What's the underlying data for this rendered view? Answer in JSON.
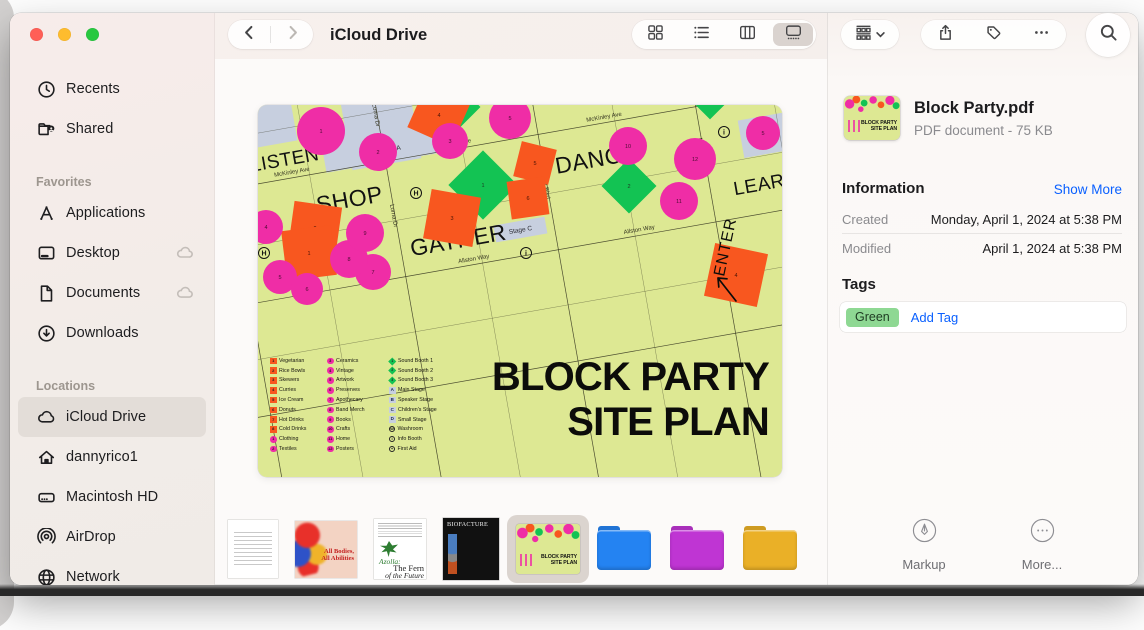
{
  "traffic_lights": {
    "close": "#ff5f57",
    "minimize": "#febc2e",
    "zoom": "#28c840"
  },
  "sidebar": {
    "top_items": [
      {
        "label": "Recents",
        "icon": "clock-icon"
      },
      {
        "label": "Shared",
        "icon": "shared-folder-icon"
      }
    ],
    "sections": [
      {
        "title": "Favorites",
        "items": [
          {
            "label": "Applications",
            "icon": "applications-icon"
          },
          {
            "label": "Desktop",
            "icon": "desktop-icon",
            "badge": "cloud-badge-icon"
          },
          {
            "label": "Documents",
            "icon": "document-icon",
            "badge": "cloud-badge-icon"
          },
          {
            "label": "Downloads",
            "icon": "downloads-icon"
          }
        ]
      },
      {
        "title": "Locations",
        "items": [
          {
            "label": "iCloud Drive",
            "icon": "icloud-icon",
            "selected": true
          },
          {
            "label": "dannyrico1",
            "icon": "home-icon"
          },
          {
            "label": "Macintosh HD",
            "icon": "harddrive-icon"
          },
          {
            "label": "AirDrop",
            "icon": "airdrop-icon"
          },
          {
            "label": "Network",
            "icon": "globe-icon"
          }
        ]
      }
    ]
  },
  "toolbar": {
    "title": "iCloud Drive",
    "view_buttons": [
      {
        "name": "icon-view",
        "icon": "view-grid-icon"
      },
      {
        "name": "list-view",
        "icon": "view-list-icon"
      },
      {
        "name": "column-view",
        "icon": "view-columns-icon"
      },
      {
        "name": "gallery-view",
        "icon": "view-gallery-icon",
        "selected": true
      }
    ],
    "actions": [
      {
        "name": "share",
        "icon": "share-icon",
        "stroked": true
      },
      {
        "name": "tags",
        "icon": "tag-icon",
        "stroked": true
      },
      {
        "name": "more",
        "icon": "ellipsis-icon"
      }
    ]
  },
  "map": {
    "bg": "#dde893",
    "colors": {
      "pink": "#ef2da6",
      "orange": "#f8571f",
      "green": "#13c353",
      "blue": "#c7cfdf"
    },
    "title": [
      "BLOCK PARTY",
      "SITE PLAN"
    ],
    "enter_label": "ENTER",
    "area_labels": [
      {
        "t": "LISTEN",
        "x": 53,
        "y": 22,
        "s": 19
      },
      {
        "t": "SHOP",
        "x": 110,
        "y": 74,
        "s": 23
      },
      {
        "t": "GATHER",
        "x": 210,
        "y": 133,
        "s": 23
      },
      {
        "t": "DANCE",
        "x": 360,
        "y": 77,
        "s": 23
      },
      {
        "t": "LEARN",
        "x": 523,
        "y": 129,
        "s": 19
      }
    ],
    "street_labels": [
      {
        "t": "McKinley Ave",
        "x": 58,
        "y": 31
      },
      {
        "t": "McKinley Ave",
        "x": 222,
        "y": 31
      },
      {
        "t": "McKinley Ave",
        "x": 375,
        "y": 31
      },
      {
        "t": "Allston Way",
        "x": 222,
        "y": 148
      },
      {
        "t": "Allston Way",
        "x": 390,
        "y": 148
      },
      {
        "t": "Lorna Dr",
        "x": 149,
        "y": -12,
        "v": 1
      },
      {
        "t": "Lorna Dr",
        "x": 149,
        "y": 90,
        "v": 1
      },
      {
        "t": "Beach Park Blvd",
        "x": 304,
        "y": 78,
        "v": 1
      },
      {
        "t": "Mayfair Ave",
        "x": 464,
        "y": 82,
        "v": 1
      }
    ],
    "stage_blocks": [
      {
        "x": 118,
        "y": -40,
        "w": 70,
        "h": 78
      },
      {
        "x": 92,
        "y": -8,
        "w": 126,
        "h": 44,
        "label": "Stage A",
        "lx": 158,
        "ly": 26
      },
      {
        "x": 25,
        "y": -49,
        "w": 44,
        "h": 48
      },
      {
        "x": 247,
        "y": 117,
        "w": 52,
        "h": 17,
        "label": "Stage C",
        "lx": 273,
        "ly": 128
      },
      {
        "x": 506,
        "y": 56,
        "w": 46,
        "h": 38,
        "label": "Stage D",
        "lx": 529,
        "ly": 78
      }
    ],
    "streets": {
      "h": [
        -60,
        35,
        152,
        265
      ],
      "v": [
        -5,
        152,
        307,
        467
      ],
      "h_minor": [
        -15,
        95,
        208
      ],
      "v_minor": [
        75,
        230,
        385,
        545
      ]
    },
    "circles": [
      [
        63,
        26,
        24,
        "1"
      ],
      [
        120,
        47,
        19,
        "2"
      ],
      [
        192,
        36,
        18,
        "3"
      ],
      [
        252,
        13,
        21,
        "5"
      ],
      [
        370,
        41,
        19,
        "10"
      ],
      [
        437,
        54,
        21,
        "12"
      ],
      [
        421,
        96,
        19,
        "11"
      ],
      [
        8,
        122,
        17,
        "4"
      ],
      [
        22,
        172,
        17,
        "5"
      ],
      [
        49,
        184,
        16,
        "6"
      ],
      [
        115,
        167,
        18,
        "7"
      ],
      [
        91,
        154,
        19,
        "8"
      ],
      [
        107,
        128,
        19,
        "9"
      ],
      [
        505,
        28,
        17,
        "5"
      ]
    ],
    "squares": [
      [
        57,
        123,
        48,
        8,
        "2"
      ],
      [
        51,
        148,
        50,
        -7,
        "1"
      ],
      [
        194,
        113,
        50,
        10,
        "3"
      ],
      [
        277,
        58,
        36,
        14,
        "5"
      ],
      [
        270,
        93,
        38,
        -8,
        "6"
      ],
      [
        181,
        10,
        48,
        24,
        "4"
      ],
      [
        478,
        170,
        54,
        12,
        "4"
      ]
    ],
    "diamonds": [
      [
        225,
        80,
        34,
        "1"
      ],
      [
        371,
        81,
        27,
        "2"
      ],
      [
        196,
        2,
        26,
        ""
      ],
      [
        452,
        -8,
        22,
        ""
      ]
    ],
    "markers": [
      [
        "H",
        158,
        88
      ],
      [
        "H",
        6,
        148
      ],
      [
        "i",
        466,
        27
      ],
      [
        "i",
        268,
        148
      ]
    ],
    "legend": {
      "columns": [
        {
          "cls": "lg-col1",
          "items": [
            [
              "sq",
              "1",
              "Vegetarian"
            ],
            [
              "sq",
              "2",
              "Rice Bowls"
            ],
            [
              "sq",
              "3",
              "Skewers"
            ],
            [
              "sq",
              "4",
              "Curries"
            ],
            [
              "sq",
              "5",
              "Ice Cream"
            ],
            [
              "sq",
              "6",
              "Donuts"
            ],
            [
              "sq",
              "7",
              "Hot Drinks"
            ],
            [
              "sq",
              "8",
              "Cold Drinks"
            ],
            [
              "pk",
              "1",
              "Clothing"
            ],
            [
              "pk",
              "2",
              "Textiles"
            ]
          ]
        },
        {
          "cls": "lg-col2",
          "items": [
            [
              "pk",
              "3",
              "Ceramics"
            ],
            [
              "pk",
              "4",
              "Vintage"
            ],
            [
              "pk",
              "5",
              "Artwork"
            ],
            [
              "pk",
              "6",
              "Preserves"
            ],
            [
              "pk",
              "7",
              "Apothecary"
            ],
            [
              "pk",
              "8",
              "Band Merch"
            ],
            [
              "pk",
              "9",
              "Books"
            ],
            [
              "pk",
              "10",
              "Crafts"
            ],
            [
              "pk",
              "11",
              "Home"
            ],
            [
              "pk",
              "12",
              "Posters"
            ]
          ]
        },
        {
          "cls": "lg-col3",
          "items": [
            [
              "gd",
              "1",
              "Sound Booth 1"
            ],
            [
              "gd",
              "2",
              "Sound Booth 2"
            ],
            [
              "gd",
              "3",
              "Sound Booth 3"
            ],
            [
              "lt",
              "A",
              "Main Stage"
            ],
            [
              "lt",
              "B",
              "Speaker Stage"
            ],
            [
              "lt",
              "C",
              "Children's Stage"
            ],
            [
              "lt",
              "D",
              "Small Stage"
            ],
            [
              "cg",
              "W",
              "Washroom"
            ],
            [
              "cg",
              "i",
              "Info Booth"
            ],
            [
              "cg",
              "+",
              "First Aid"
            ]
          ]
        }
      ]
    }
  },
  "filmstrip": {
    "items": [
      {
        "kind": "doc-letter"
      },
      {
        "kind": "doc-art",
        "t1": "All Bodies,",
        "t2": "All Abilities"
      },
      {
        "kind": "doc-fern",
        "t1": "Azolla:",
        "t2": "The Fern",
        "t3": "of the Future"
      },
      {
        "kind": "doc-bio",
        "t1": "BIOFACTURE"
      },
      {
        "kind": "siteplan",
        "selected": true,
        "t1": "BLOCK PARTY",
        "t2": "SITE PLAN"
      },
      {
        "kind": "folder",
        "color": "#2483f2"
      },
      {
        "kind": "folder",
        "color": "#bf35d3"
      },
      {
        "kind": "folder",
        "color": "#eab027"
      }
    ]
  },
  "inspector": {
    "file_name": "Block Party.pdf",
    "file_meta": "PDF document - 75 KB",
    "thumb": {
      "t1": "BLOCK PARTY",
      "t2": "SITE PLAN"
    },
    "info_heading": "Information",
    "show_more": "Show More",
    "rows": [
      {
        "label": "Created",
        "value": "Monday, April 1, 2024 at 5:38 PM"
      },
      {
        "label": "Modified",
        "value": "April 1, 2024 at 5:38 PM"
      }
    ],
    "tags_heading": "Tags",
    "tags": [
      {
        "label": "Green",
        "color": "#8ed893"
      }
    ],
    "add_tag": "Add Tag",
    "buttons": [
      {
        "label": "Markup",
        "icon": "markup-icon"
      },
      {
        "label": "More...",
        "icon": "more-circle-icon"
      }
    ]
  }
}
